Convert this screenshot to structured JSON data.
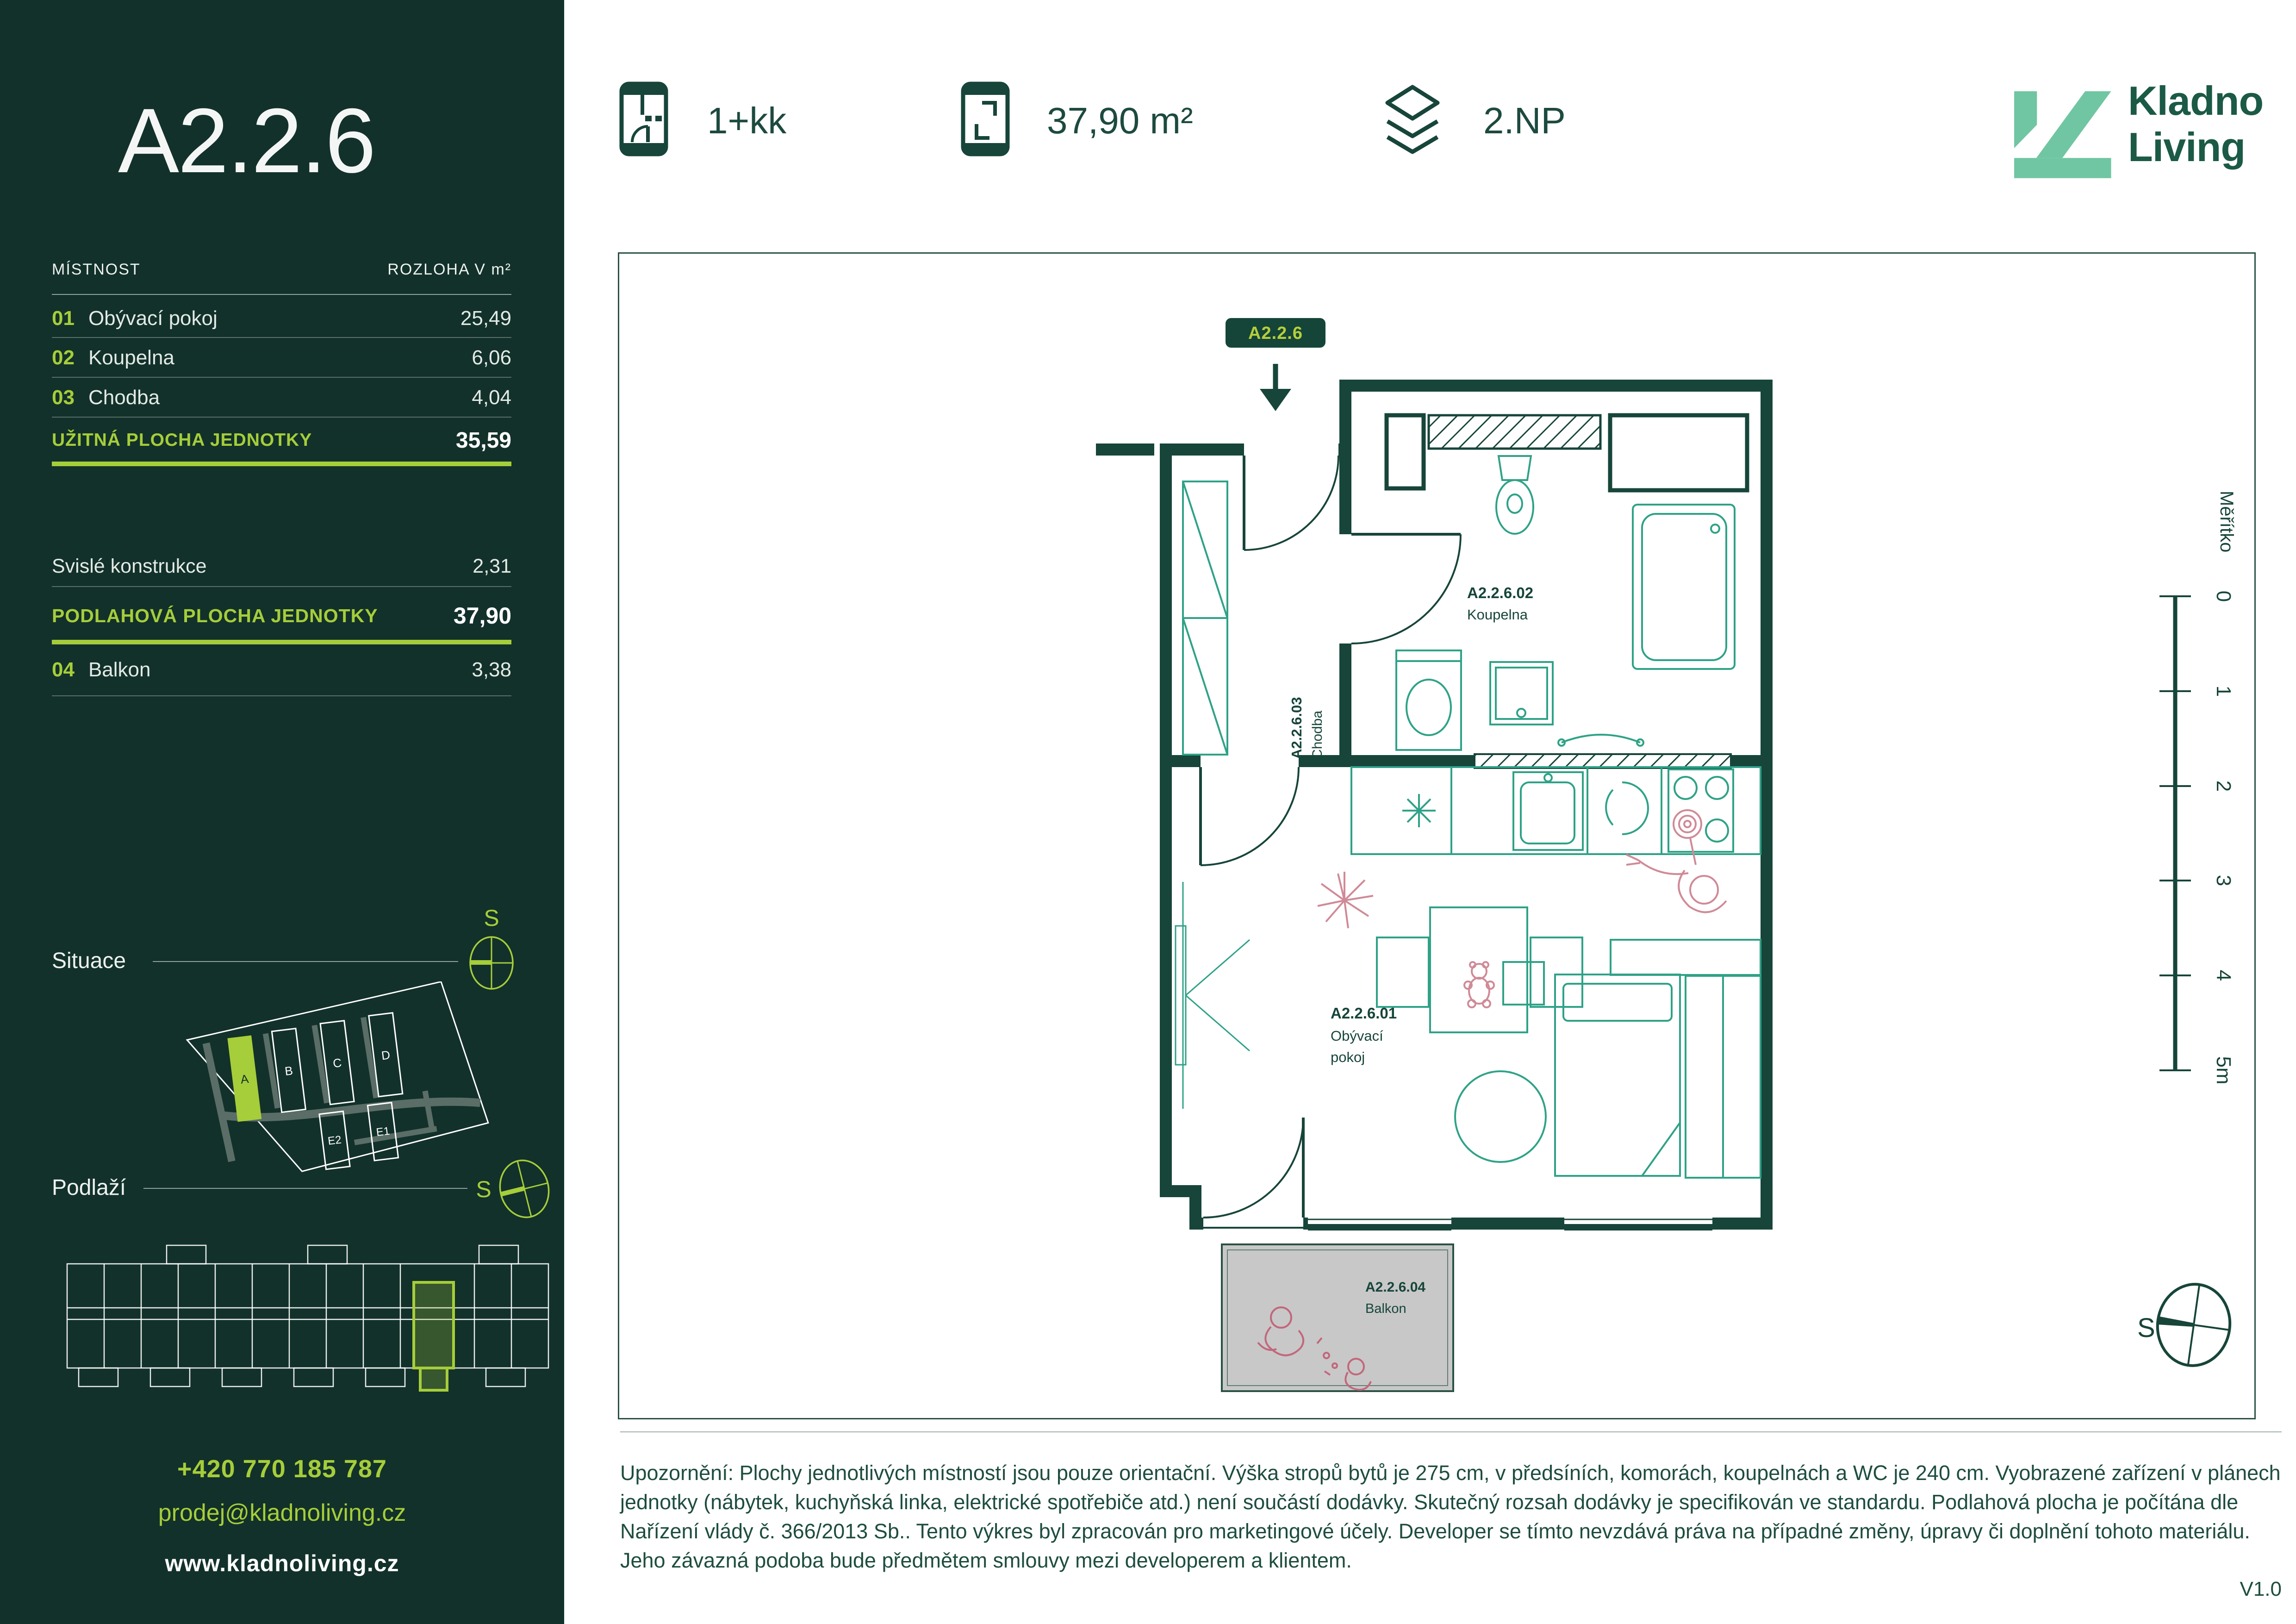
{
  "sidebar": {
    "unit_code": "A2.2.6",
    "table": {
      "header": {
        "room": "MÍSTNOST",
        "area": "ROZLOHA V m²"
      },
      "rows": [
        {
          "num": "01",
          "name": "Obývací pokoj",
          "area": "25,49"
        },
        {
          "num": "02",
          "name": "Koupelna",
          "area": "6,06"
        },
        {
          "num": "03",
          "name": "Chodba",
          "area": "4,04"
        }
      ],
      "usable": {
        "label": "UŽITNÁ PLOCHA JEDNOTKY",
        "value": "35,59"
      },
      "vertical": {
        "label": "Svislé konstrukce",
        "value": "2,31"
      },
      "floor": {
        "label": "PODLAHOVÁ PLOCHA JEDNOTKY",
        "value": "37,90"
      },
      "balcony": {
        "num": "04",
        "name": "Balkon",
        "value": "3,38"
      }
    },
    "situace": {
      "label": "Situace",
      "compass": "S",
      "buildings": [
        "A",
        "B",
        "C",
        "D",
        "E2",
        "E1"
      ]
    },
    "podlazi": {
      "label": "Podlaží",
      "compass": "S"
    },
    "contact": {
      "phone": "+420 770 185 787",
      "email": "prodej@kladnoliving.cz",
      "web": "www.kladnoliving.cz"
    }
  },
  "header": {
    "layout": "1+kk",
    "area": "37,90 m²",
    "floor": "2.NP",
    "brand1": "Kladno",
    "brand2": "Living"
  },
  "plan": {
    "tag": "A2.2.6",
    "rooms": {
      "living": {
        "code": "A2.2.6.01",
        "line1": "Obývací",
        "line2": "pokoj"
      },
      "bath": {
        "code": "A2.2.6.02",
        "name": "Koupelna"
      },
      "hall": {
        "code": "A2.2.6.03",
        "name": "Chodba"
      },
      "balcony": {
        "code": "A2.2.6.04",
        "name": "Balkon"
      }
    },
    "scale": {
      "label": "Měřítko",
      "ticks": [
        "0",
        "1",
        "2",
        "3",
        "4",
        "5m"
      ]
    },
    "compass": "S"
  },
  "footer": {
    "disclaimer": "Upozornění: Plochy jednotlivých místností jsou pouze orientační. Výška stropů bytů je 275 cm, v předsíních, komorách, koupelnách a WC je 240 cm. Vyobrazené zařízení v plánech jednotky (nábytek, kuchyňská linka, elektrické spotřebiče atd.) není součástí dodávky. Skutečný rozsah dodávky je specifikován ve standardu. Podlahová plocha je počítána dle Nařízení vlády č. 366/2013 Sb.. Tento výkres byl zpracován pro marketingové účely. Developer se tímto nevzdává práva na případné změny, úpravy či doplnění tohoto materiálu. Jeho závazná podoba bude předmětem smlouvy mezi developerem a klientem.",
    "version": "V1.0"
  },
  "colors": {
    "sidebar_bg": "#12312a",
    "accent_green": "#a6cd3a",
    "dark_green": "#17453a",
    "brand_green": "#1b5a46",
    "logo_mint": "#70c6a2",
    "furniture_teal": "#2fa287",
    "figure_pink": "#d08a97",
    "balcony_gray": "#c8c8c8"
  }
}
